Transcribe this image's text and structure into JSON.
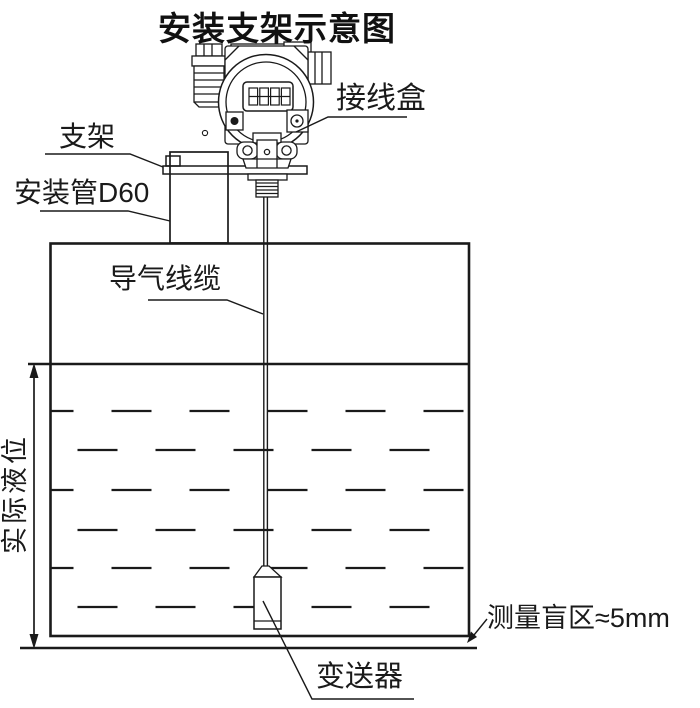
{
  "title": "安装支架示意图",
  "labels": {
    "junction_box": "接线盒",
    "bracket": "支架",
    "mounting_pipe": "安装管D60",
    "air_cable": "导气线缆",
    "actual_level": "实际液位",
    "blind_zone": "测量盲区≈5mm",
    "transmitter": "变送器"
  },
  "transmitter_display": {
    "digits": "8888"
  },
  "colors": {
    "line": "#1a1a1a",
    "background": "#ffffff"
  }
}
